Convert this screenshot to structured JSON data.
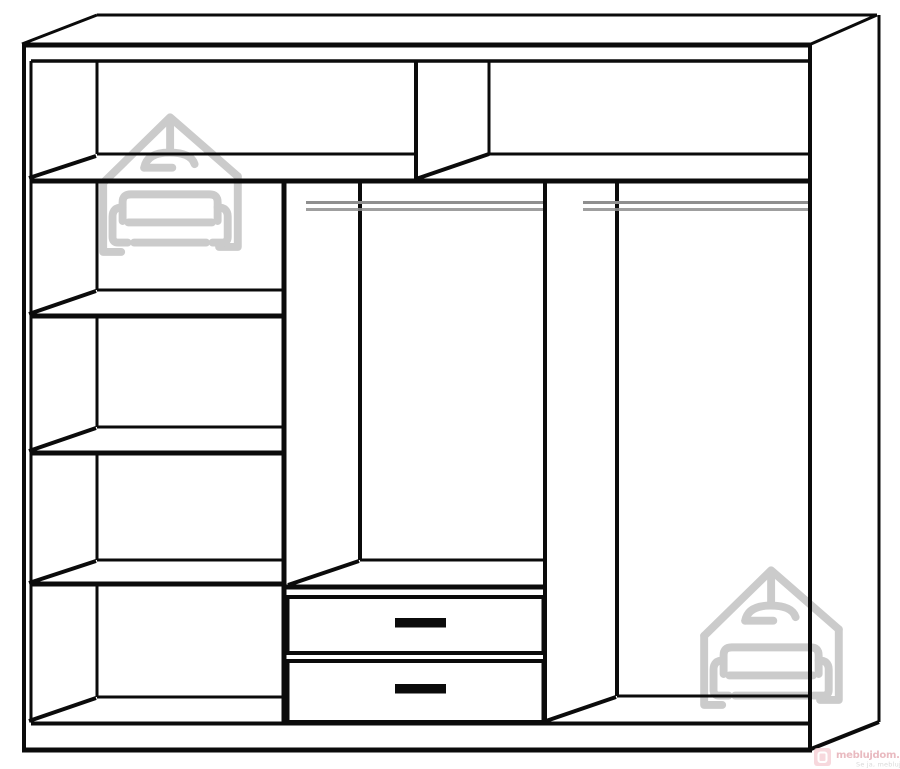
{
  "page": {
    "width": 900,
    "height": 769,
    "background": "#ffffff"
  },
  "diagram": {
    "title": "Wardrobe interior technical line drawing",
    "line_color": "#0b0b0b",
    "rail_color": "#8f8f8f",
    "watermark_color": "#cbcbcb",
    "components": {
      "top_section": "full-width top shelf split into two compartments",
      "left_column": "four open shelf compartments",
      "middle_section": "hanging rail above shelf with two drawers",
      "right_section": "full-height hanging rail compartment",
      "hanging_rail_count": 2,
      "drawer_count": 2
    }
  },
  "brand": {
    "logo_text": "meblujdom.pl",
    "tagline": "Se ja, mebluj dom!",
    "text_color": "#e2a3ac",
    "tagline_color": "#d6d6d6",
    "badge_color": "#f5ced4"
  }
}
